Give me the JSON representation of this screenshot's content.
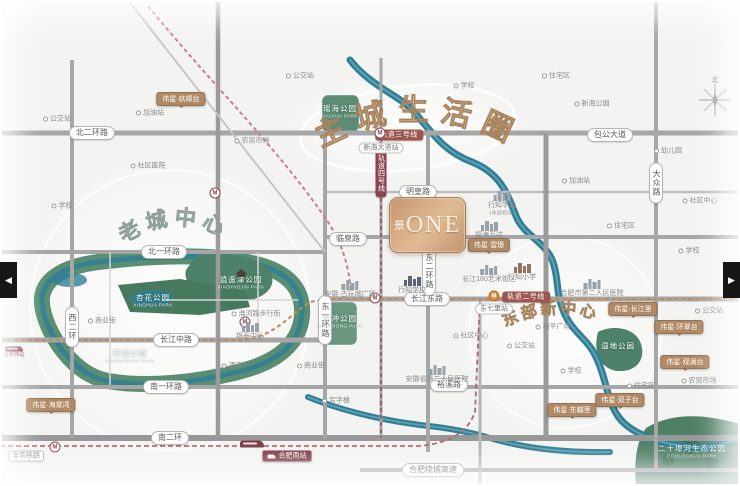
{
  "title": "楼盘区位图",
  "project": {
    "prefix": "景",
    "name": "ONE"
  },
  "watermarks": {
    "main": "主城生活圈",
    "old_town": "老城中心",
    "east": "东部新中心"
  },
  "carousel": {
    "prev_icon": "◀",
    "next_icon": "▶"
  },
  "compass": {
    "label": "北"
  },
  "icons": {
    "metro": "M"
  },
  "colors": {
    "background": "#f3f3f1",
    "road": "#a6a6a6",
    "river": "#2f7e96",
    "park": "#4e8169",
    "bronze": "#c59670",
    "badge_brown": "#b08a66",
    "metro_maroon": "#8d4350",
    "station_red": "#7c3a46"
  },
  "road_labels": [
    {
      "t": "北二环路",
      "x": 92,
      "y": 133
    },
    {
      "t": "包公大道",
      "x": 610,
      "y": 135
    },
    {
      "t": "明皇路",
      "x": 418,
      "y": 192
    },
    {
      "t": "临泉路",
      "x": 348,
      "y": 239
    },
    {
      "t": "北一环路",
      "x": 164,
      "y": 252
    },
    {
      "t": "长江东路",
      "x": 427,
      "y": 299
    },
    {
      "t": "长江中路",
      "x": 176,
      "y": 340
    },
    {
      "t": "南一环路",
      "x": 166,
      "y": 387
    },
    {
      "t": "裕溪路",
      "x": 449,
      "y": 385
    },
    {
      "t": "南二环",
      "x": 170,
      "y": 438
    },
    {
      "t": "合肥绕城高速",
      "x": 433,
      "y": 470
    },
    {
      "t": "淮南铁路",
      "x": 26,
      "y": 456,
      "plain": true
    },
    {
      "t": "西二环",
      "x": 72,
      "y": 327,
      "v": true
    },
    {
      "t": "东一环路",
      "x": 325,
      "y": 320,
      "v": true
    },
    {
      "t": "东二环路",
      "x": 429,
      "y": 271,
      "v": true
    },
    {
      "t": "大众路",
      "x": 656,
      "y": 183,
      "v": true
    }
  ],
  "metro_badges": [
    {
      "t": "轨道三号线",
      "x": 399,
      "y": 135
    },
    {
      "t": "轨道二号线",
      "x": 526,
      "y": 297
    },
    {
      "t": "轨道四号线",
      "x": 381,
      "y": 173,
      "v": true
    }
  ],
  "station_labels": [
    {
      "t": "新海大道站",
      "x": 381,
      "y": 148
    },
    {
      "t": "东七里站",
      "x": 494,
      "y": 309
    }
  ],
  "project_badges": [
    {
      "t": "伟星·玖樟台",
      "x": 181,
      "y": 99
    },
    {
      "t": "伟星·雲璟",
      "x": 489,
      "y": 245
    },
    {
      "t": "伟星·长江里",
      "x": 633,
      "y": 309
    },
    {
      "t": "伟星·环翠台",
      "x": 679,
      "y": 327
    },
    {
      "t": "伟星·观澜台",
      "x": 685,
      "y": 362
    },
    {
      "t": "伟星·双子台",
      "x": 620,
      "y": 400
    },
    {
      "t": "伟星·东樾里",
      "x": 572,
      "y": 410
    },
    {
      "t": "伟星·海棠湾",
      "x": 51,
      "y": 405
    }
  ],
  "transit": {
    "metro": [
      {
        "x": 380,
        "y": 133
      },
      {
        "x": 375,
        "y": 298
      },
      {
        "x": 245,
        "y": 322
      },
      {
        "x": 215,
        "y": 193
      },
      {
        "x": 55,
        "y": 447
      }
    ],
    "metro_orange": [
      {
        "x": 494,
        "y": 296
      }
    ],
    "train": [
      {
        "x": 252,
        "y": 444
      },
      {
        "x": 14,
        "y": 349,
        "label": "合肥西站"
      }
    ]
  },
  "south_station": {
    "t": "合肥南站",
    "x": 287,
    "y": 456
  },
  "parks": [
    {
      "n": "瑶海公园",
      "en": "YAOHAI PARK",
      "x": 340,
      "y": 112
    },
    {
      "n": "逍遥津公园",
      "en": "XIAOYAOJIN PARK",
      "x": 241,
      "y": 280,
      "icon": "pavilion"
    },
    {
      "n": "杏花公园",
      "en": "XINGHUA PARK",
      "x": 153,
      "y": 301
    },
    {
      "n": "环城公园",
      "en": "HUANCHENG PARK",
      "x": 130,
      "y": 357
    },
    {
      "n": "花冲公园",
      "en": "HUACHONG PARK",
      "x": 340,
      "y": 322
    },
    {
      "n": "湿地公园",
      "x": 618,
      "y": 346
    },
    {
      "n": "二十埠河生态公园",
      "en": "ECOLOGICAL PARK",
      "x": 692,
      "y": 452
    }
  ],
  "pois": [
    {
      "t": "行知学校",
      "sub": "(本部校区)",
      "x": 502,
      "y": 204,
      "bldg": "gray"
    },
    {
      "t": "福海万达",
      "x": 489,
      "y": 230,
      "bldg": "gray"
    },
    {
      "t": "行知小学",
      "x": 522,
      "y": 272,
      "bldg": "brown"
    },
    {
      "t": "行知学校",
      "x": 412,
      "y": 285,
      "bldg": "navy"
    },
    {
      "t": "安徽·古玩城广场",
      "x": 350,
      "y": 289,
      "bldg": "gray"
    },
    {
      "t": "长江180艺术街区",
      "x": 489,
      "y": 274,
      "bldg": "gray"
    },
    {
      "t": "合肥市第二人民医院",
      "x": 592,
      "y": 288,
      "bldg": "gray"
    },
    {
      "t": "安徽省第二人民医院",
      "x": 437,
      "y": 374,
      "bldg": "gray"
    },
    {
      "t": "银泰中心",
      "x": 250,
      "y": 331,
      "bldg": "gray"
    },
    {
      "t": "淮河路步行街",
      "x": 256,
      "y": 314
    },
    {
      "t": "和平广场",
      "x": 553,
      "y": 327
    },
    {
      "t": "新海公园",
      "x": 592,
      "y": 104
    },
    {
      "t": "公交站",
      "x": 57,
      "y": 119
    },
    {
      "t": "加油站",
      "x": 150,
      "y": 113
    },
    {
      "t": "社区医院",
      "x": 148,
      "y": 166
    },
    {
      "t": "农贸市场",
      "x": 252,
      "y": 141
    },
    {
      "t": "学校",
      "x": 62,
      "y": 206
    },
    {
      "t": "公交站",
      "x": 300,
      "y": 76
    },
    {
      "t": "学校",
      "x": 464,
      "y": 86
    },
    {
      "t": "住宅区",
      "x": 556,
      "y": 76
    },
    {
      "t": "幼儿园",
      "x": 668,
      "y": 151
    },
    {
      "t": "社区中心",
      "x": 700,
      "y": 201
    },
    {
      "t": "加油站",
      "x": 576,
      "y": 181
    },
    {
      "t": "住宅区",
      "x": 621,
      "y": 226
    },
    {
      "t": "学校",
      "x": 689,
      "y": 251
    },
    {
      "t": "公交站",
      "x": 709,
      "y": 311
    },
    {
      "t": "农贸市场",
      "x": 699,
      "y": 381
    },
    {
      "t": "住宅区",
      "x": 641,
      "y": 386
    },
    {
      "t": "商业街",
      "x": 311,
      "y": 366
    },
    {
      "t": "酒店",
      "x": 232,
      "y": 366
    },
    {
      "t": "写字楼",
      "x": 336,
      "y": 401
    },
    {
      "t": "公交站",
      "x": 521,
      "y": 346
    },
    {
      "t": "学校",
      "x": 571,
      "y": 371
    },
    {
      "t": "社区中心",
      "x": 471,
      "y": 336
    },
    {
      "t": "商业街",
      "x": 102,
      "y": 321
    }
  ]
}
